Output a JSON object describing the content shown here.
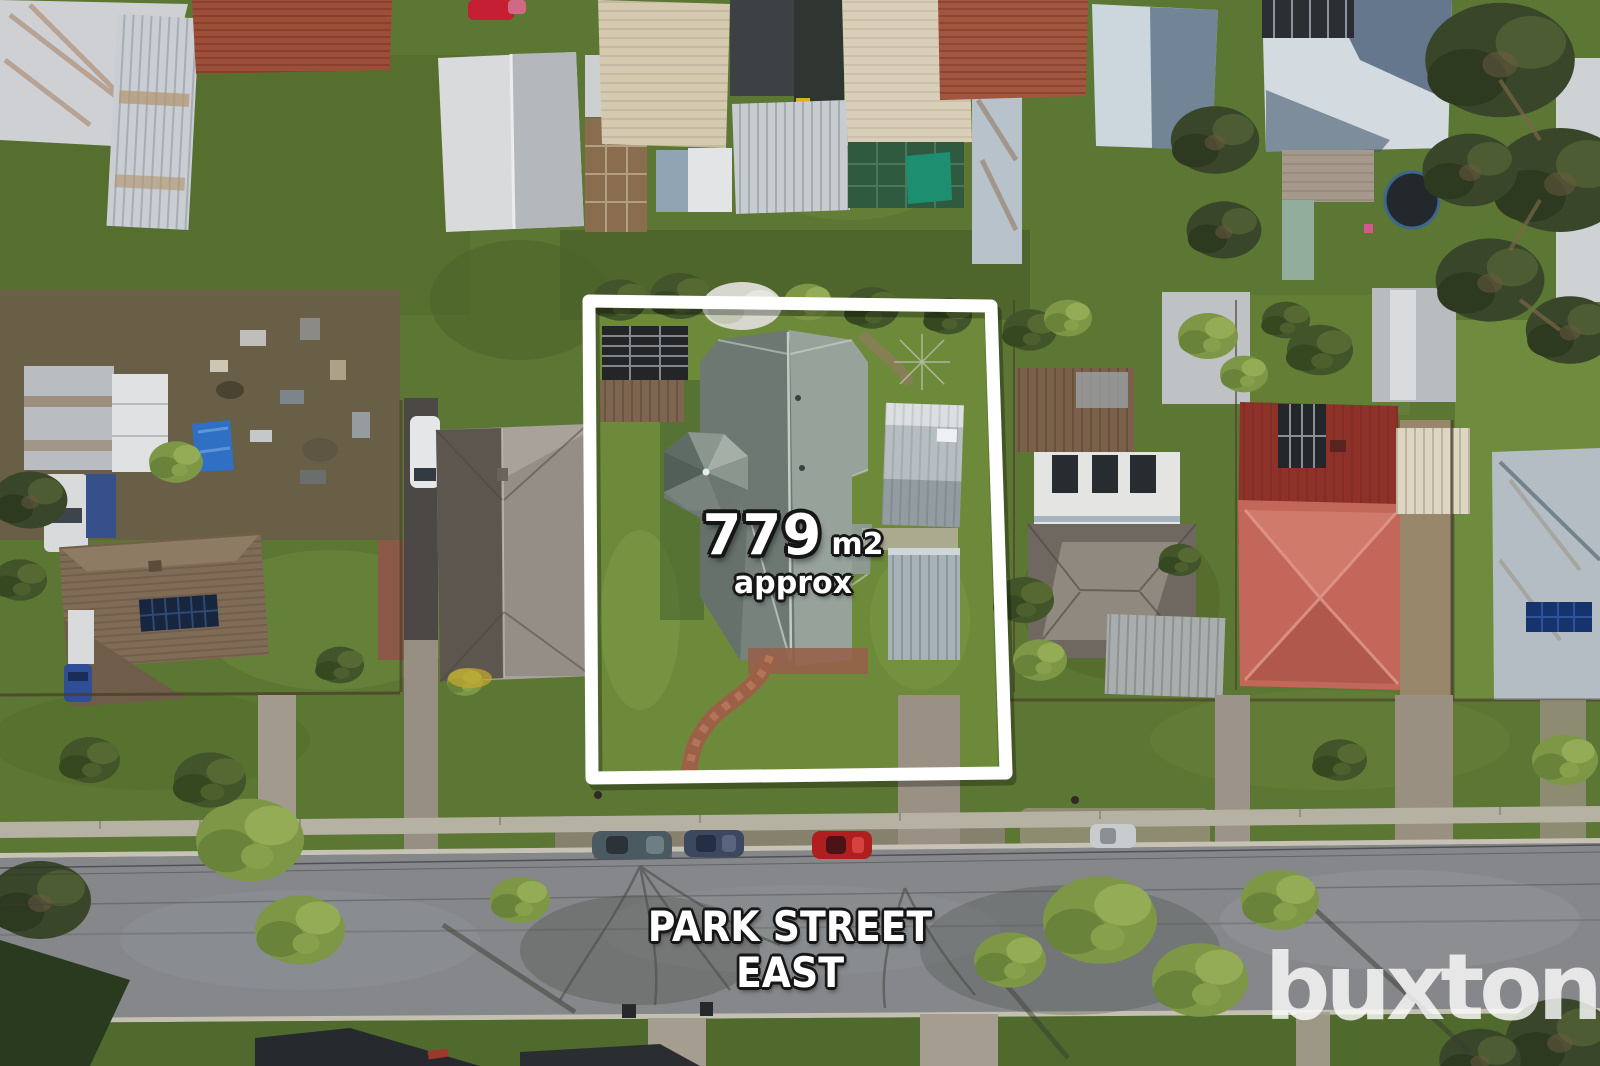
{
  "photo": {
    "kind": "aerial-property-photo",
    "boundary_color": "#ffffff",
    "parked_cars_visible": 4
  },
  "area_overlay": {
    "value": "779",
    "unit": "m2",
    "qualifier": "approx",
    "text_color": "#ffffff",
    "outline_color": "#161616"
  },
  "street_overlay": {
    "name": "PARK STREET EAST",
    "text_color": "#ffffff",
    "outline_color": "#161616"
  },
  "watermark": {
    "text": "buxton",
    "color": "#ffffff",
    "opacity": "0.8"
  },
  "scene_colors": {
    "grass": "#5c7733",
    "road": "#85878a",
    "featured_roof": "#7f8b84",
    "red_roof_dark": "#8d3129",
    "red_roof_light": "#c2675a",
    "bin_green": "#2f9440",
    "bin_yellow": "#d7a912",
    "car_red": "#b01f1f"
  }
}
